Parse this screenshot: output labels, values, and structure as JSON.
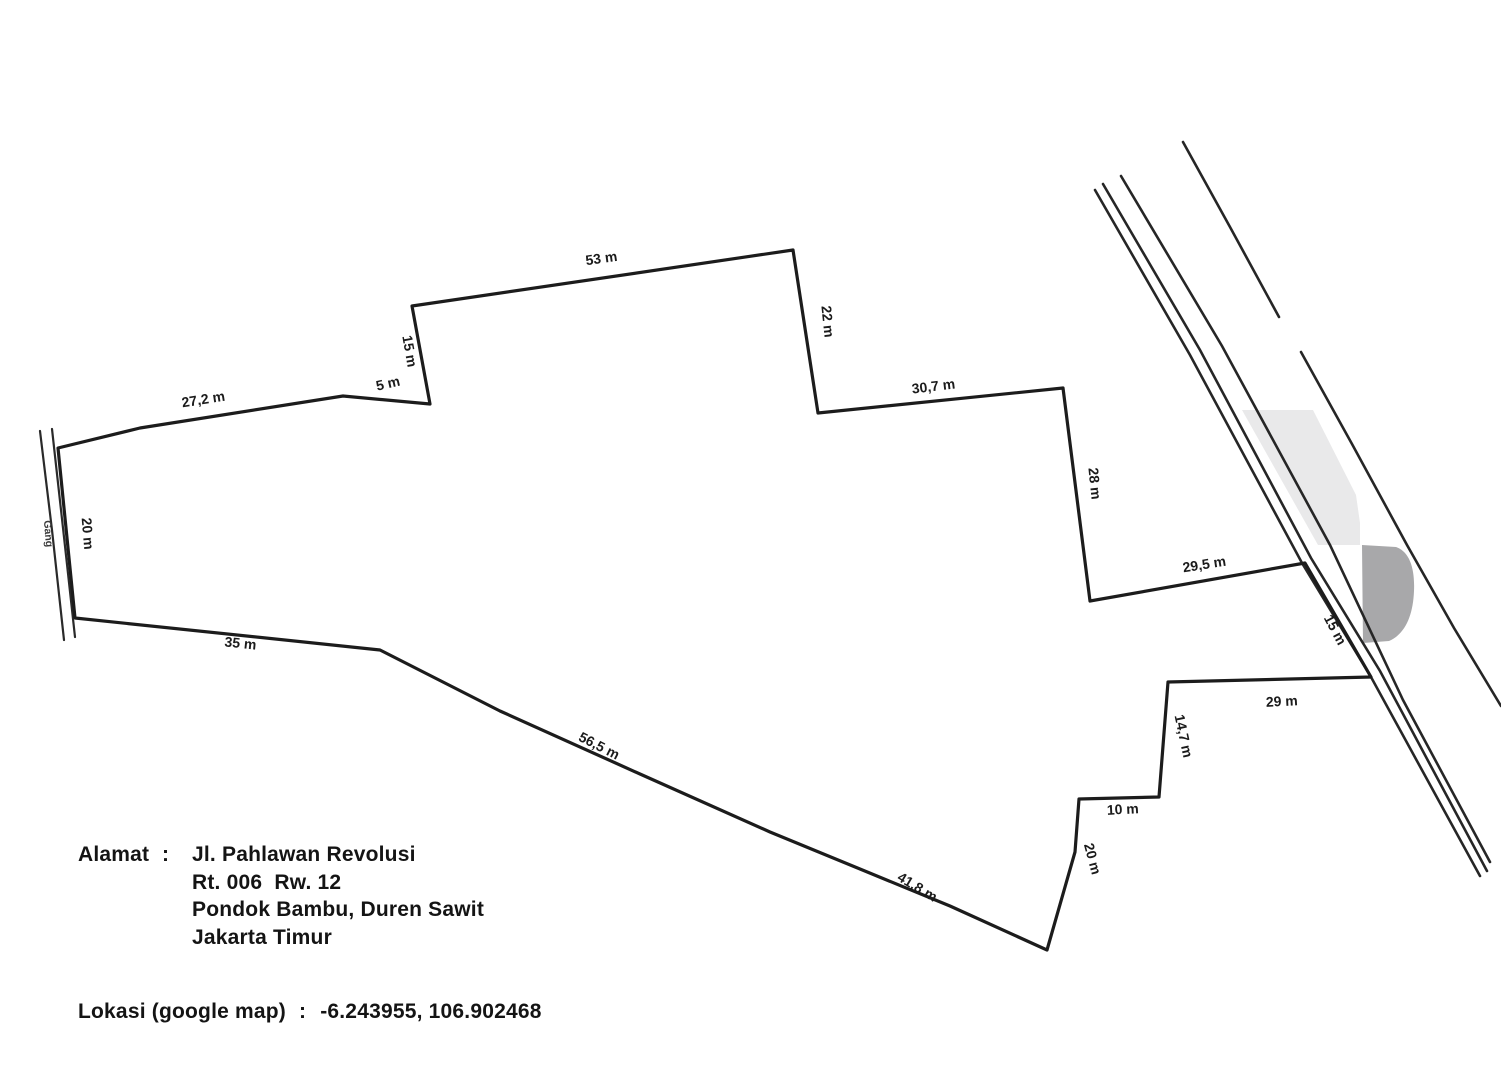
{
  "document": {
    "type_note": "hand-drawn land parcel site plan"
  },
  "colors": {
    "line": "#1c1c1c",
    "road_line": "#2a2a2a",
    "building_light": "#e9e9ea",
    "building_dark": "#a8a8aa",
    "background": "#ffffff",
    "text": "#141414"
  },
  "parcel": {
    "edges": [
      {
        "name": "west-notch",
        "label": "15 m"
      },
      {
        "name": "north-1",
        "label": "53 m"
      },
      {
        "name": "east-1",
        "label": "22 m"
      },
      {
        "name": "north-2",
        "label": "30,7 m"
      },
      {
        "name": "east-2",
        "label": "28 m"
      },
      {
        "name": "north-3",
        "label": "29,5 m"
      },
      {
        "name": "road-frontage",
        "label": "15 m"
      },
      {
        "name": "north-4",
        "label": "29 m"
      },
      {
        "name": "east-3",
        "label": "14,7 m"
      },
      {
        "name": "north-5",
        "label": "10 m"
      },
      {
        "name": "east-4",
        "label": "20 m"
      },
      {
        "name": "south-1",
        "label": "41,8 m"
      },
      {
        "name": "south-2",
        "label": "56,5 m"
      },
      {
        "name": "south-3",
        "label": "35 m"
      },
      {
        "name": "west",
        "label": "20 m"
      },
      {
        "name": "northwest-1",
        "label": "27,2 m"
      },
      {
        "name": "northwest-2",
        "label": "5 m"
      }
    ],
    "alley_label": "Gang"
  },
  "address": {
    "label": "Alamat",
    "colon": ":",
    "lines": [
      "Jl. Pahlawan Revolusi",
      "Rt. 006  Rw. 12",
      "Pondok Bambu, Duren Sawit",
      "Jakarta Timur"
    ]
  },
  "location": {
    "label": "Lokasi (google map)",
    "colon": ":",
    "value": "-6.243955, 106.902468"
  }
}
